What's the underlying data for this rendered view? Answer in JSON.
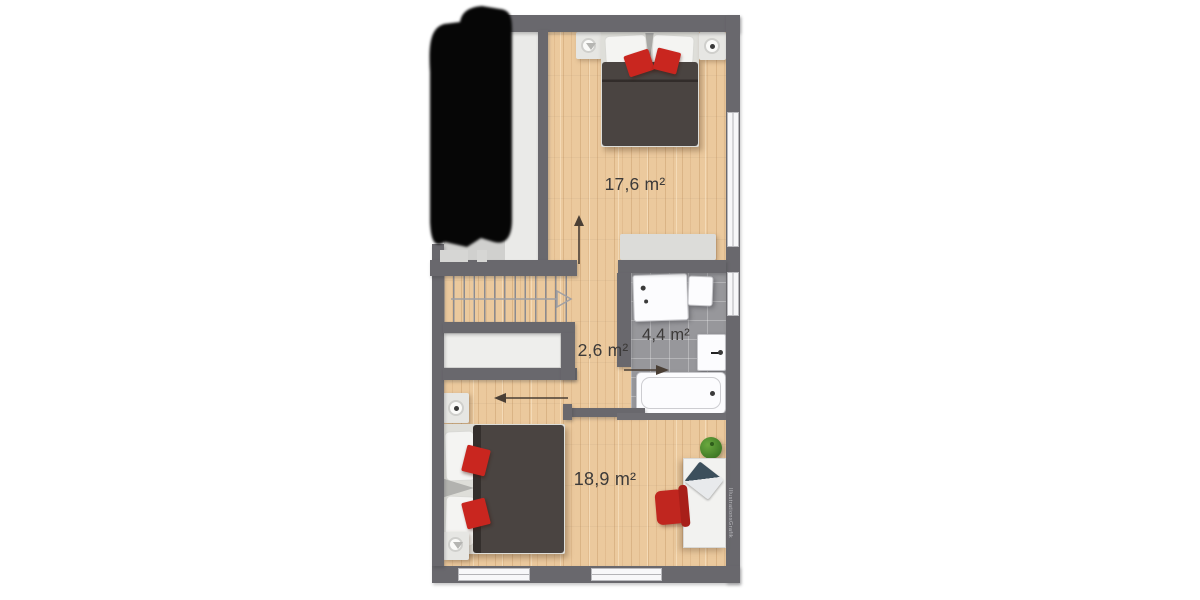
{
  "floor_plan": {
    "rooms": [
      {
        "name": "bedroom-upper",
        "area_label": "17,6 m²"
      },
      {
        "name": "hallway",
        "area_label": "2,6 m²"
      },
      {
        "name": "bathroom",
        "area_label": "4,4 m²"
      },
      {
        "name": "bedroom-lower",
        "area_label": "18,9 m²"
      }
    ],
    "watermark": "IllustrationsGrafik",
    "colors": {
      "wall": "#69686d",
      "wood_floor": "#ebc99d",
      "tile_floor": "#97979b",
      "duvet": "#4a4441",
      "accent_red": "#c9261f",
      "plant_green": "#4e8c2f",
      "redaction": "#060606"
    },
    "furniture_icons": [
      "double-bed",
      "nightstand-lamp",
      "sideboard",
      "stairs-up",
      "closet",
      "shower",
      "bath-cabinet",
      "sink",
      "bathtub",
      "desk",
      "laptop",
      "office-chair",
      "plant",
      "door-swing-arrow"
    ]
  }
}
